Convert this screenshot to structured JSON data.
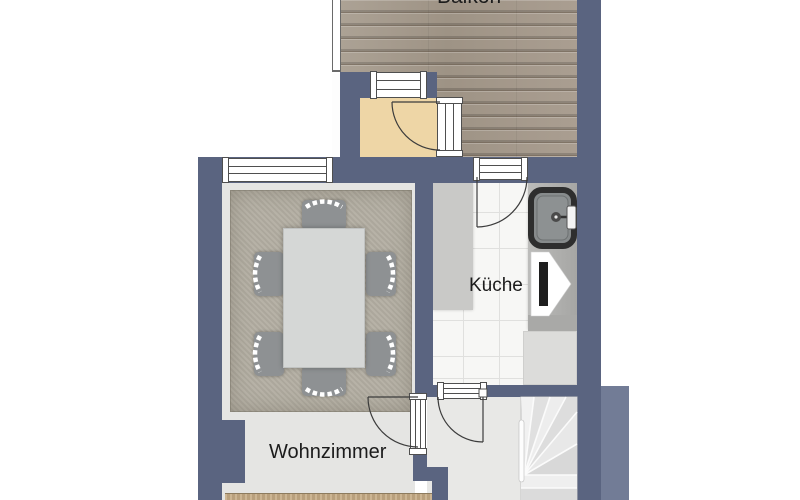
{
  "plan": {
    "type": "floor-plan",
    "labels": {
      "balcony": "Balkon",
      "kitchen": "Küche",
      "living_room": "Wohnzimmer"
    },
    "rooms": [
      {
        "name": "Balkon",
        "floor": "wood-deck"
      },
      {
        "name": "Küche",
        "floor": "white-tile",
        "fixtures": [
          "sink",
          "counter",
          "appliance"
        ]
      },
      {
        "name": "Wohnzimmer",
        "floor": "light-gray",
        "furniture": [
          "rug",
          "dining-table",
          "6 chairs"
        ]
      },
      {
        "name": "entry-room",
        "floor": "beige"
      },
      {
        "name": "hallway",
        "fixtures": [
          "winder-stairs"
        ]
      }
    ],
    "colors": {
      "wall": "#5a6480",
      "wall_light": "#727c96",
      "balcony_wood": "#a89d90",
      "entry_floor": "#eed6a6",
      "room_floor": "#e5e5e3",
      "rug": "#b3aea2",
      "kitchen_tile": "#f7f7f5",
      "counter": "#b6b6b4",
      "background": "#ffffff",
      "label_text": "#1c1c1c"
    }
  }
}
